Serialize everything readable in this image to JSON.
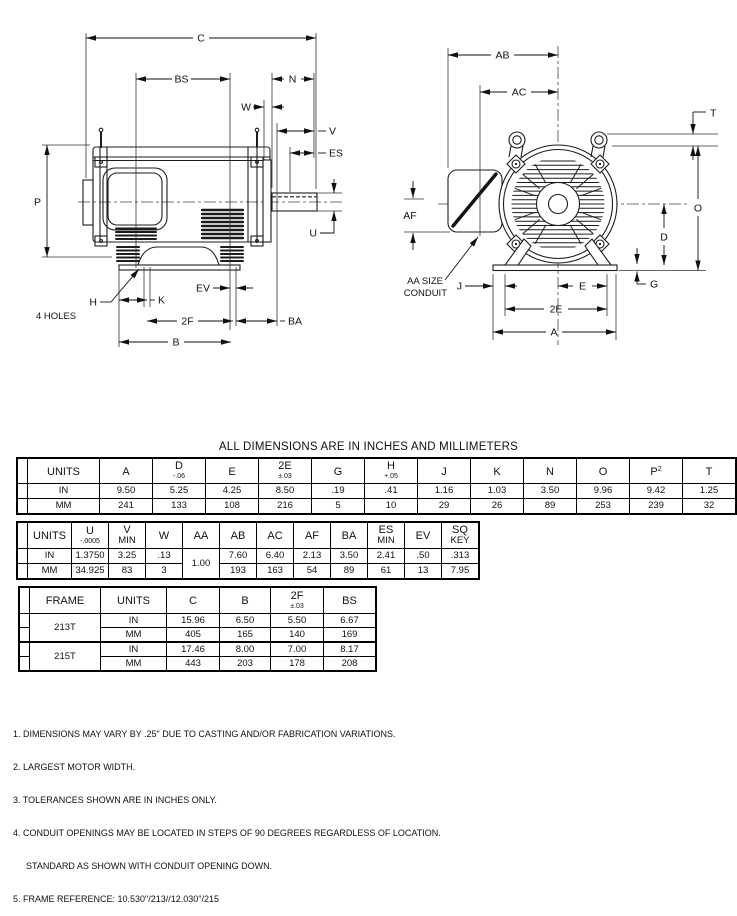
{
  "title": "ALL DIMENSIONS ARE IN INCHES AND MILLIMETERS",
  "svg": {
    "side": {
      "C": "C",
      "BS": "BS",
      "N": "N",
      "W": "W",
      "V": "V",
      "ES": "ES",
      "P": "P",
      "U": "U",
      "H": "H",
      "HOLES": "4 HOLES",
      "K": "K",
      "EV": "EV",
      "F2": "2F",
      "BA": "BA",
      "B": "B"
    },
    "front": {
      "AB": "AB",
      "AC": "AC",
      "T": "T",
      "O": "O",
      "D": "D",
      "G": "G",
      "AF": "AF",
      "AA1": "AA SIZE",
      "AA2": "CONDUIT",
      "J": "J",
      "E": "E",
      "E2": "2E",
      "A": "A"
    }
  },
  "tables": {
    "t1": {
      "headers": [
        {
          "label": "UNITS"
        },
        {
          "label": "A"
        },
        {
          "label": "D",
          "tol": "-.06"
        },
        {
          "label": "E"
        },
        {
          "label": "2E",
          "tol": "±.03"
        },
        {
          "label": "G"
        },
        {
          "label": "H",
          "tol": "+.05"
        },
        {
          "label": "J"
        },
        {
          "label": "K"
        },
        {
          "label": "N"
        },
        {
          "label": "O"
        },
        {
          "label": "P",
          "sup": "2"
        },
        {
          "label": "T"
        }
      ],
      "rows": [
        {
          "units": "IN",
          "values": [
            "9.50",
            "5.25",
            "4.25",
            "8.50",
            ".19",
            ".41",
            "1.16",
            "1.03",
            "3.50",
            "9.96",
            "9.42",
            "1.25"
          ]
        },
        {
          "units": "MM",
          "values": [
            "241",
            "133",
            "108",
            "216",
            "5",
            "10",
            "29",
            "26",
            "89",
            "253",
            "239",
            "32"
          ]
        }
      ]
    },
    "t2": {
      "headers": [
        {
          "label": "UNITS"
        },
        {
          "label": "U",
          "tol": "-.0005"
        },
        {
          "label": "V",
          "line2": "MIN"
        },
        {
          "label": "W"
        },
        {
          "label": "AA"
        },
        {
          "label": "AB"
        },
        {
          "label": "AC"
        },
        {
          "label": "AF"
        },
        {
          "label": "BA"
        },
        {
          "label": "ES",
          "line2": "MIN"
        },
        {
          "label": "EV"
        },
        {
          "label": "SQ",
          "line2": "KEY"
        }
      ],
      "aa_value": "1.00",
      "rows": [
        {
          "units": "IN",
          "values": [
            "1.3750",
            "3.25",
            ".13",
            "7.60",
            "6.40",
            "2.13",
            "3.50",
            "2.41",
            ".50",
            ".313"
          ]
        },
        {
          "units": "MM",
          "values": [
            "34.925",
            "83",
            "3",
            "193",
            "163",
            "54",
            "89",
            "61",
            "13",
            "7.95"
          ]
        }
      ]
    },
    "t3": {
      "headers": [
        {
          "label": "FRAME"
        },
        {
          "label": "UNITS"
        },
        {
          "label": "C"
        },
        {
          "label": "B"
        },
        {
          "label": "2F",
          "tol": "±.03"
        },
        {
          "label": "BS"
        }
      ],
      "groups": [
        {
          "frame": "213T",
          "rows": [
            {
              "units": "IN",
              "values": [
                "15.96",
                "6.50",
                "5.50",
                "6.67"
              ]
            },
            {
              "units": "MM",
              "values": [
                "405",
                "165",
                "140",
                "169"
              ]
            }
          ]
        },
        {
          "frame": "215T",
          "rows": [
            {
              "units": "IN",
              "values": [
                "17.46",
                "8.00",
                "7.00",
                "8.17"
              ]
            },
            {
              "units": "MM",
              "values": [
                "443",
                "203",
                "178",
                "208"
              ]
            }
          ]
        }
      ]
    }
  },
  "notes": [
    "1. DIMENSIONS MAY VARY BY .25\" DUE TO CASTING AND/OR FABRICATION VARIATIONS.",
    "2. LARGEST MOTOR WIDTH.",
    "3. TOLERANCES SHOWN ARE IN INCHES ONLY.",
    "4. CONDUIT OPENINGS MAY BE LOCATED IN STEPS OF 90 DEGREES REGARDLESS OF LOCATION.",
    "STANDARD AS SHOWN WITH CONDUIT OPENING DOWN.",
    "5. FRAME REFERENCE: 10.530\"/213//12.030\"/215"
  ]
}
